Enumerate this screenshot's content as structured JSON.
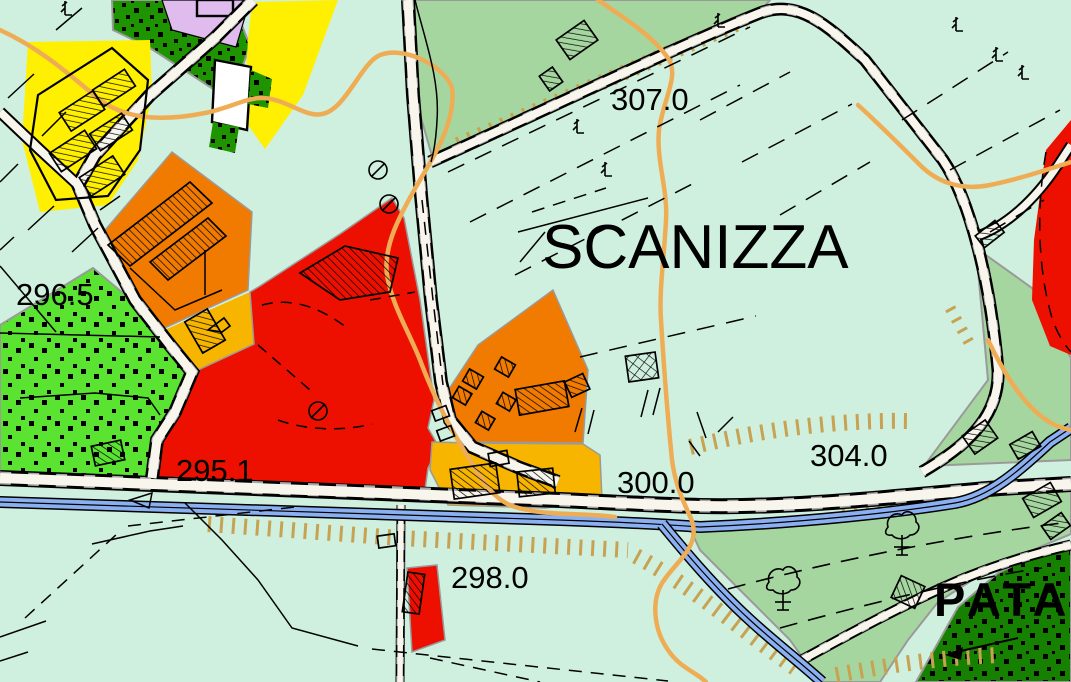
{
  "map_labels": {
    "scanizza": "SCANIZZA",
    "pata": "PATA"
  },
  "elevation_labels": {
    "e296_5": "296.5",
    "e307_0": "307.0",
    "e295_1": "295.1",
    "e300_0": "300.0",
    "e304_0": "304.0",
    "e298_0": "298.0"
  },
  "colors": {
    "background_mint": "#cff0df",
    "pasture_green": "#a6d6a0",
    "forest_green": "#1e9500",
    "forest_dark_green": "#168000",
    "scrub_bright_green": "#5ae331",
    "residential_yellow": "#ffef00",
    "residential_lavender": "#dfbbee",
    "industrial_orange": "#f17b00",
    "mixed_amber": "#f7b500",
    "zone_red": "#ed1000",
    "river_blue": "#8ab0f2",
    "road_white": "#f8f5ec",
    "road_tick_gray": "#a7a7a7",
    "path_tan": "#eead55",
    "slope_hatch_tan": "#c8a253",
    "parcel_white": "#ffffff",
    "label_black": "#000000"
  }
}
